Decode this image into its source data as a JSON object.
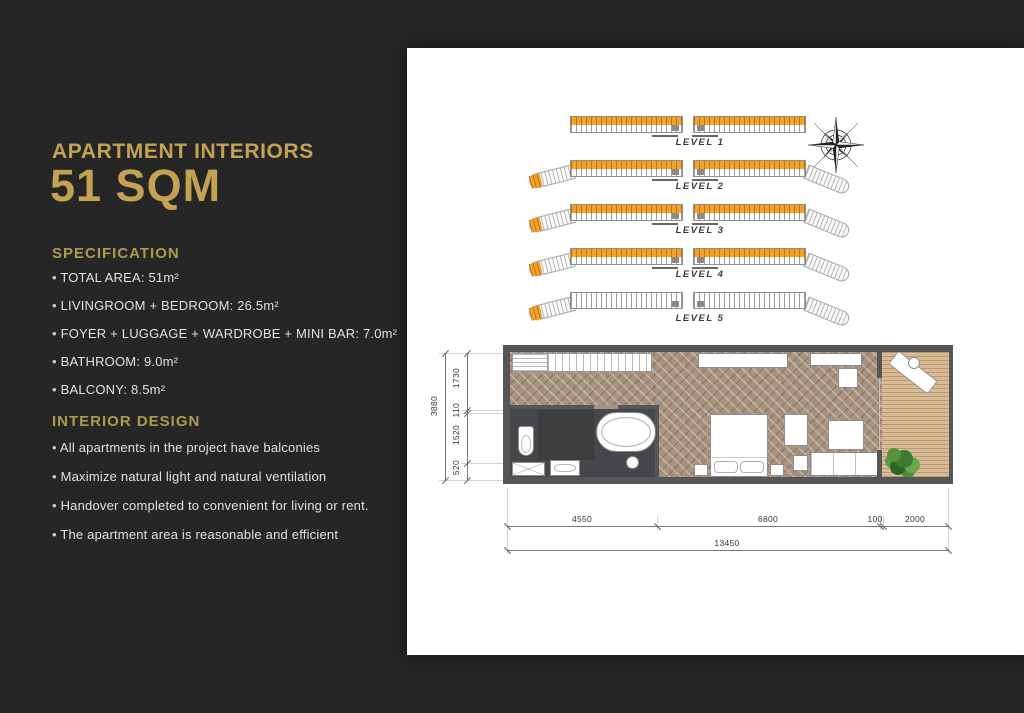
{
  "colors": {
    "background": "#262627",
    "panel": "#ffffff",
    "accent_gold": "#c3a254",
    "heading_gold": "#ac9b4d",
    "highlight_orange": "#f3a227",
    "wall_gray": "#56565a"
  },
  "left_panel": {
    "subtitle": "APARTMENT INTERIORS",
    "title": "51 SQM",
    "specification": {
      "heading": "SPECIFICATION",
      "items": [
        "TOTAL AREA: 51m²",
        "LIVINGROOM + BEDROOM: 26.5m²",
        "FOYER + LUGGAGE + WARDROBE + MINI BAR: 7.0m²",
        "BATHROOM: 9.0m²",
        "BALCONY: 8.5m²"
      ]
    },
    "interior_design": {
      "heading": "INTERIOR DESIGN",
      "items": [
        "All apartments in the project have balconies",
        "Maximize natural light and natural ventilation",
        "Handover completed to convenient for living or rent.",
        "The apartment area is reasonable and efficient"
      ]
    }
  },
  "levels_diagram": {
    "levels": [
      {
        "label": "LEVEL 1"
      },
      {
        "label": "LEVEL 2"
      },
      {
        "label": "LEVEL 3"
      },
      {
        "label": "LEVEL 4"
      },
      {
        "label": "LEVEL 5"
      }
    ]
  },
  "icons": {
    "compass": "compass-rose"
  },
  "floorplan": {
    "vertical_dims": {
      "total": "3880",
      "segments": [
        "1730",
        "110",
        "1520",
        "520"
      ]
    },
    "horizontal_dims": {
      "total": "13450",
      "segments": [
        "4550",
        "6800",
        "100",
        "2000"
      ]
    }
  }
}
